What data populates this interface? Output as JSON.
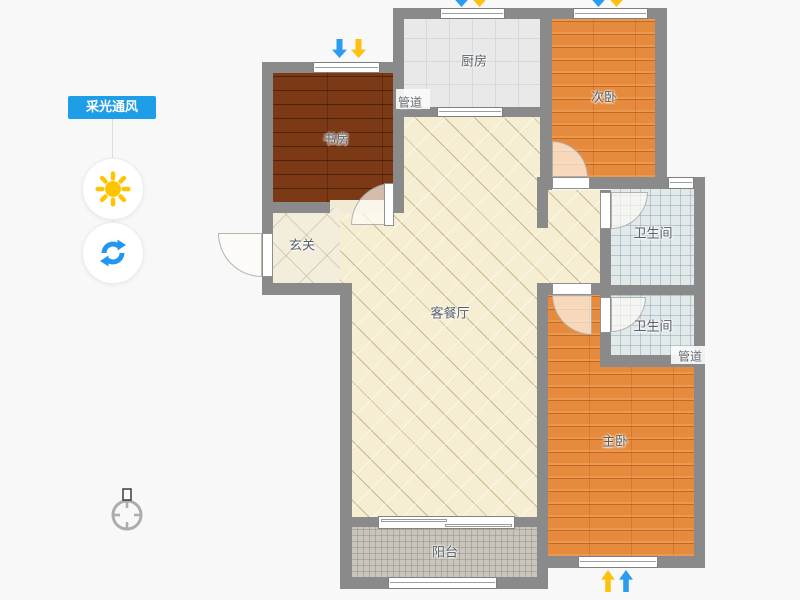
{
  "toolbar": {
    "label": "采光通风",
    "accent_color": "#1f9ee8",
    "sun_icon_color": "#ffc400",
    "rotate_icon_color": "#2196f3"
  },
  "floorplan": {
    "wall_color": "#8a8a8a",
    "rooms": {
      "study": {
        "label": "书房"
      },
      "kitchen": {
        "label": "厨房"
      },
      "bedroom2": {
        "label": "次卧"
      },
      "bath1": {
        "label": "卫生间"
      },
      "bath2": {
        "label": "卫生间"
      },
      "entry": {
        "label": "玄关"
      },
      "living": {
        "label": "客餐厅"
      },
      "master": {
        "label": "主卧"
      },
      "balcony": {
        "label": "阳台"
      }
    },
    "ducts": {
      "kitchen": "管道",
      "bath": "管道"
    },
    "arrows": {
      "light_color": "#ffc10e",
      "wind_color": "#2b9df0",
      "locations": [
        "study-window",
        "kitchen-window",
        "bedroom2-window",
        "master-window"
      ]
    }
  }
}
